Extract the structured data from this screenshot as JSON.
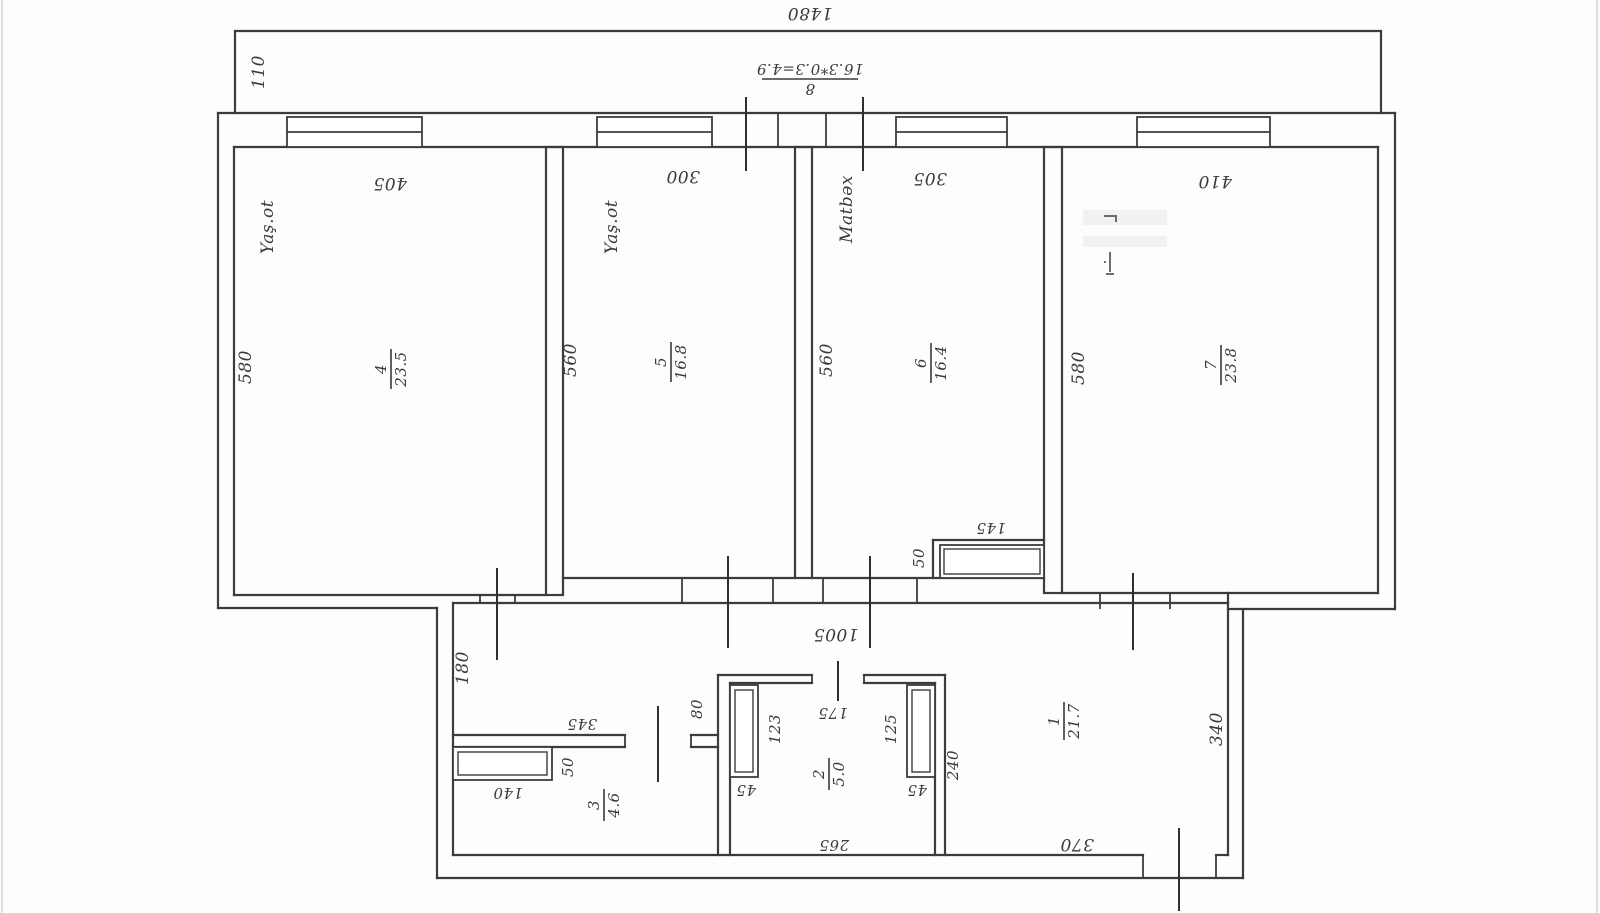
{
  "plan": {
    "balcony": {
      "width_dim": "1480",
      "depth_dim": "110",
      "formula_top": "16.3*0.3=4.9",
      "formula_bottom": "8"
    },
    "hall": {
      "width_dim": "1005",
      "left_depth_dim": "180",
      "shaft_dim": "80"
    },
    "rooms": {
      "room4": {
        "name": "Yaş.ot",
        "number": "4",
        "area": "23.5",
        "width_dim": "405",
        "depth_dim": "580"
      },
      "room5": {
        "name": "Yaş.ot",
        "number": "5",
        "area": "16.8",
        "width_dim": "300",
        "depth_dim": "560"
      },
      "room6": {
        "name": "Matbəx",
        "number": "6",
        "area": "16.4",
        "width_dim": "305",
        "depth_dim": "560",
        "niche_width_dim": "145",
        "niche_depth_dim": "50"
      },
      "room7": {
        "number": "7",
        "area": "23.8",
        "width_dim": "410",
        "depth_dim": "580"
      },
      "room1": {
        "number": "1",
        "area": "21.7",
        "bottom_dim": "370",
        "right_dim": "340"
      },
      "room2": {
        "number": "2",
        "area": "5.0",
        "top_dim": "175",
        "bottom_dim": "265",
        "left_fixture_dim": "123",
        "right_fixture_dim": "125",
        "left_gap_dim": "45",
        "right_gap_dim": "45",
        "right_wall_dim": "240"
      },
      "room3": {
        "number": "3",
        "area": "4.6",
        "top_dim": "345",
        "closet_width_dim": "140",
        "closet_depth_dim": "50"
      }
    }
  }
}
